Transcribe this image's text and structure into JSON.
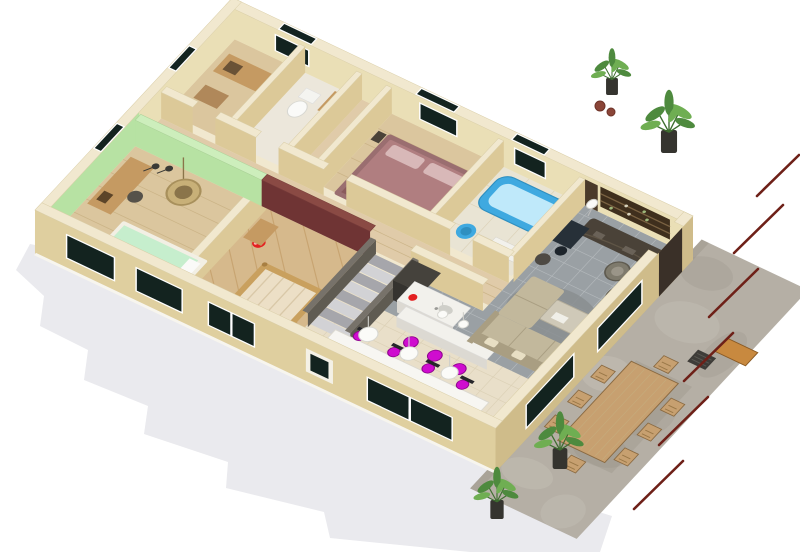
{
  "scene": {
    "type": "3d-isometric-floor-plan-render",
    "background": "#ffffff",
    "storeys": 1,
    "view": "aerial-three-quarter"
  },
  "palette": {
    "background": "#ffffff",
    "shadow": "#eaeaee",
    "wall_top": "#f1e8cf",
    "wall_face": "#eadfb6",
    "wall_face_shade": "#dcc998",
    "facade": "#dfcf9f",
    "facade_side": "#cfbc8a",
    "wall_green": "#b7e2a3",
    "wall_green_top": "#cdeebc",
    "wall_maroon": "#6f3434",
    "window_dark": "#13231f",
    "window_frame": "#ffffff",
    "floor_wood": "#dbc69e",
    "floor_wood_line": "#c6ad7f",
    "floor_wood2": "#d6b98c",
    "floor_hall": "#e0cba9",
    "floor_tile_gray": "#9aa0a4",
    "tile_grout": "#b7bcc0",
    "floor_tile_beige": "#e9dfc9",
    "beige_grout": "#d8cdb2",
    "floor_bath": "#e9e4d4",
    "terrace_stone": "#b5afa5",
    "stone_dark": "#9c958a",
    "stone_light": "#c6c0b6",
    "accent_magenta": "#cf0ccf",
    "magenta_dark": "#8f068f",
    "accent_red": "#e32020",
    "tub_blue": "#3fa9e0",
    "tub_blue_light": "#bfe9fa",
    "bed_mauve": "#b07e80",
    "bed_mauve_light": "#d8b8b8",
    "bed_mint": "#c6eecd",
    "sofa": "#c2b89c",
    "sofa_shade": "#a99e82",
    "dark_wood": "#4a4238",
    "dark_appliance": "#45423c",
    "counter_white": "#f2f1ec",
    "counter_face": "#dcd9d2",
    "wood_mid": "#c59a62",
    "wood_crib": "#c9a05e",
    "wood_out": "#c7a070",
    "wood_out_dark": "#8a6a42",
    "wicker": "#c8b078",
    "plant_green": "#4e8a3e",
    "plant_green_light": "#6fae52",
    "pot_dark": "#35342f",
    "rail_red": "#6e2018",
    "stair_light": "#d2d2d5",
    "stair_dark": "#a6a6ab",
    "stringer": "#77726a",
    "rug": "#8a8e91",
    "white": "#fafaf8"
  },
  "rooms": [
    {
      "id": "green-bedroom",
      "label": "Bedroom (green walls)",
      "furniture": [
        "desk",
        "floor lamps",
        "hanging wicker chair",
        "mint single bed"
      ]
    },
    {
      "id": "nursery",
      "label": "Nursery (maroon accent wall)",
      "furniture": [
        "wooden crib",
        "red ball",
        "dresser"
      ]
    },
    {
      "id": "staircase",
      "label": "Staircase",
      "furniture": [
        "steps",
        "stringer walls"
      ]
    },
    {
      "id": "bedroom-2",
      "label": "Bedroom (mauve bed)",
      "furniture": [
        "double bed",
        "nightstands"
      ]
    },
    {
      "id": "bathroom",
      "label": "Bathroom",
      "furniture": [
        "blue bathtub",
        "blue stool",
        "vanity"
      ]
    },
    {
      "id": "wc",
      "label": "WC",
      "furniture": [
        "toilet",
        "washbasin"
      ]
    },
    {
      "id": "laundry",
      "label": "Storage / laundry",
      "furniture": [
        "sideboard",
        "shelf"
      ]
    },
    {
      "id": "kitchen",
      "label": "Kitchen",
      "furniture": [
        "fridge",
        "island with sink",
        "red kettle",
        "bar counter"
      ]
    },
    {
      "id": "dining",
      "label": "Dining area",
      "furniture": [
        "long white table",
        "magenta chairs",
        "bar stools",
        "sphere pendant lamps"
      ]
    },
    {
      "id": "living-room",
      "label": "Living room",
      "furniture": [
        "corner sofa",
        "coffee table",
        "area rug",
        "barrel chairs",
        "side table",
        "TV sideboard",
        "wall shelf",
        "desk",
        "plants"
      ]
    }
  ],
  "terrace": {
    "label": "Stone terrace",
    "furniture": [
      "outdoor wooden dining table",
      "wooden chairs",
      "console table",
      "grill",
      "potted plants"
    ],
    "fence_rails": 6
  },
  "counts": {
    "dining_chairs": 8,
    "bar_stools": 3,
    "pendant_lamps": 5,
    "terrace_chairs": 8,
    "fence_rails": 6,
    "facade_windows": 5,
    "back_wall_windows": 3
  }
}
